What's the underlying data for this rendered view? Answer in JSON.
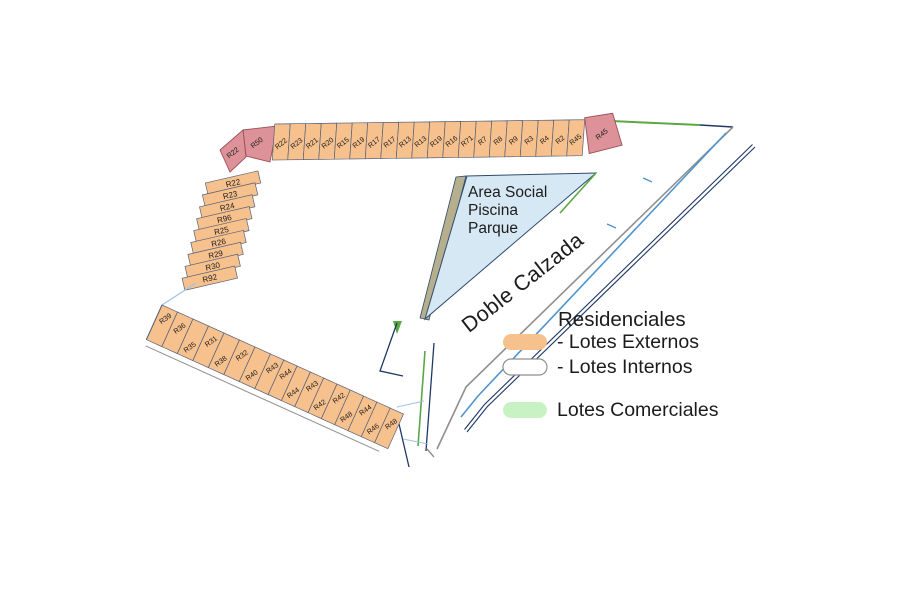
{
  "area_social": {
    "lines": [
      "Area Social",
      "Piscina",
      "Parque"
    ]
  },
  "road": {
    "label": "Doble Calzada"
  },
  "legend": {
    "title": "Residenciales",
    "items": [
      {
        "label": "- Lotes Externos",
        "color": "#f7c18d"
      },
      {
        "label": "- Lotes Internos",
        "color": "#ffffff"
      },
      {
        "label": "Lotes Comerciales",
        "color": "#c9f2c4"
      }
    ]
  },
  "lots": {
    "corner_pink": [
      "R50",
      "R22"
    ],
    "top_row": [
      "R22",
      "R23",
      "R21",
      "R20",
      "R15",
      "R19",
      "R17",
      "R17",
      "R13",
      "R13",
      "R19",
      "R16",
      "R71",
      "R7",
      "R8",
      "R9",
      "R3",
      "R4",
      "R2",
      "R45"
    ],
    "top_row_end_pink": "R45",
    "left_column": [
      "R22",
      "R23",
      "R24",
      "R96",
      "R25",
      "R26",
      "R29",
      "R30",
      "R92"
    ],
    "bottom_row": [
      "R39",
      "R36",
      "R35",
      "R31",
      "R38",
      "R32",
      "R40",
      "R43",
      "R44",
      "R44",
      "R43",
      "R42",
      "R42",
      "R48",
      "R44",
      "R46",
      "R48"
    ]
  },
  "colors": {
    "lot_external": "#f7c18d",
    "lot_corner": "#dd9198",
    "water_area": "#d6e8f4",
    "khaki_strip": "#b5af8e",
    "commercial_green": "#5aa744",
    "legend_green": "#c9f2c4",
    "road_navy": "#1f3864",
    "road_gray": "#8f8f8f",
    "road_blue": "#4f94cd",
    "text": "#1c1c1c"
  }
}
